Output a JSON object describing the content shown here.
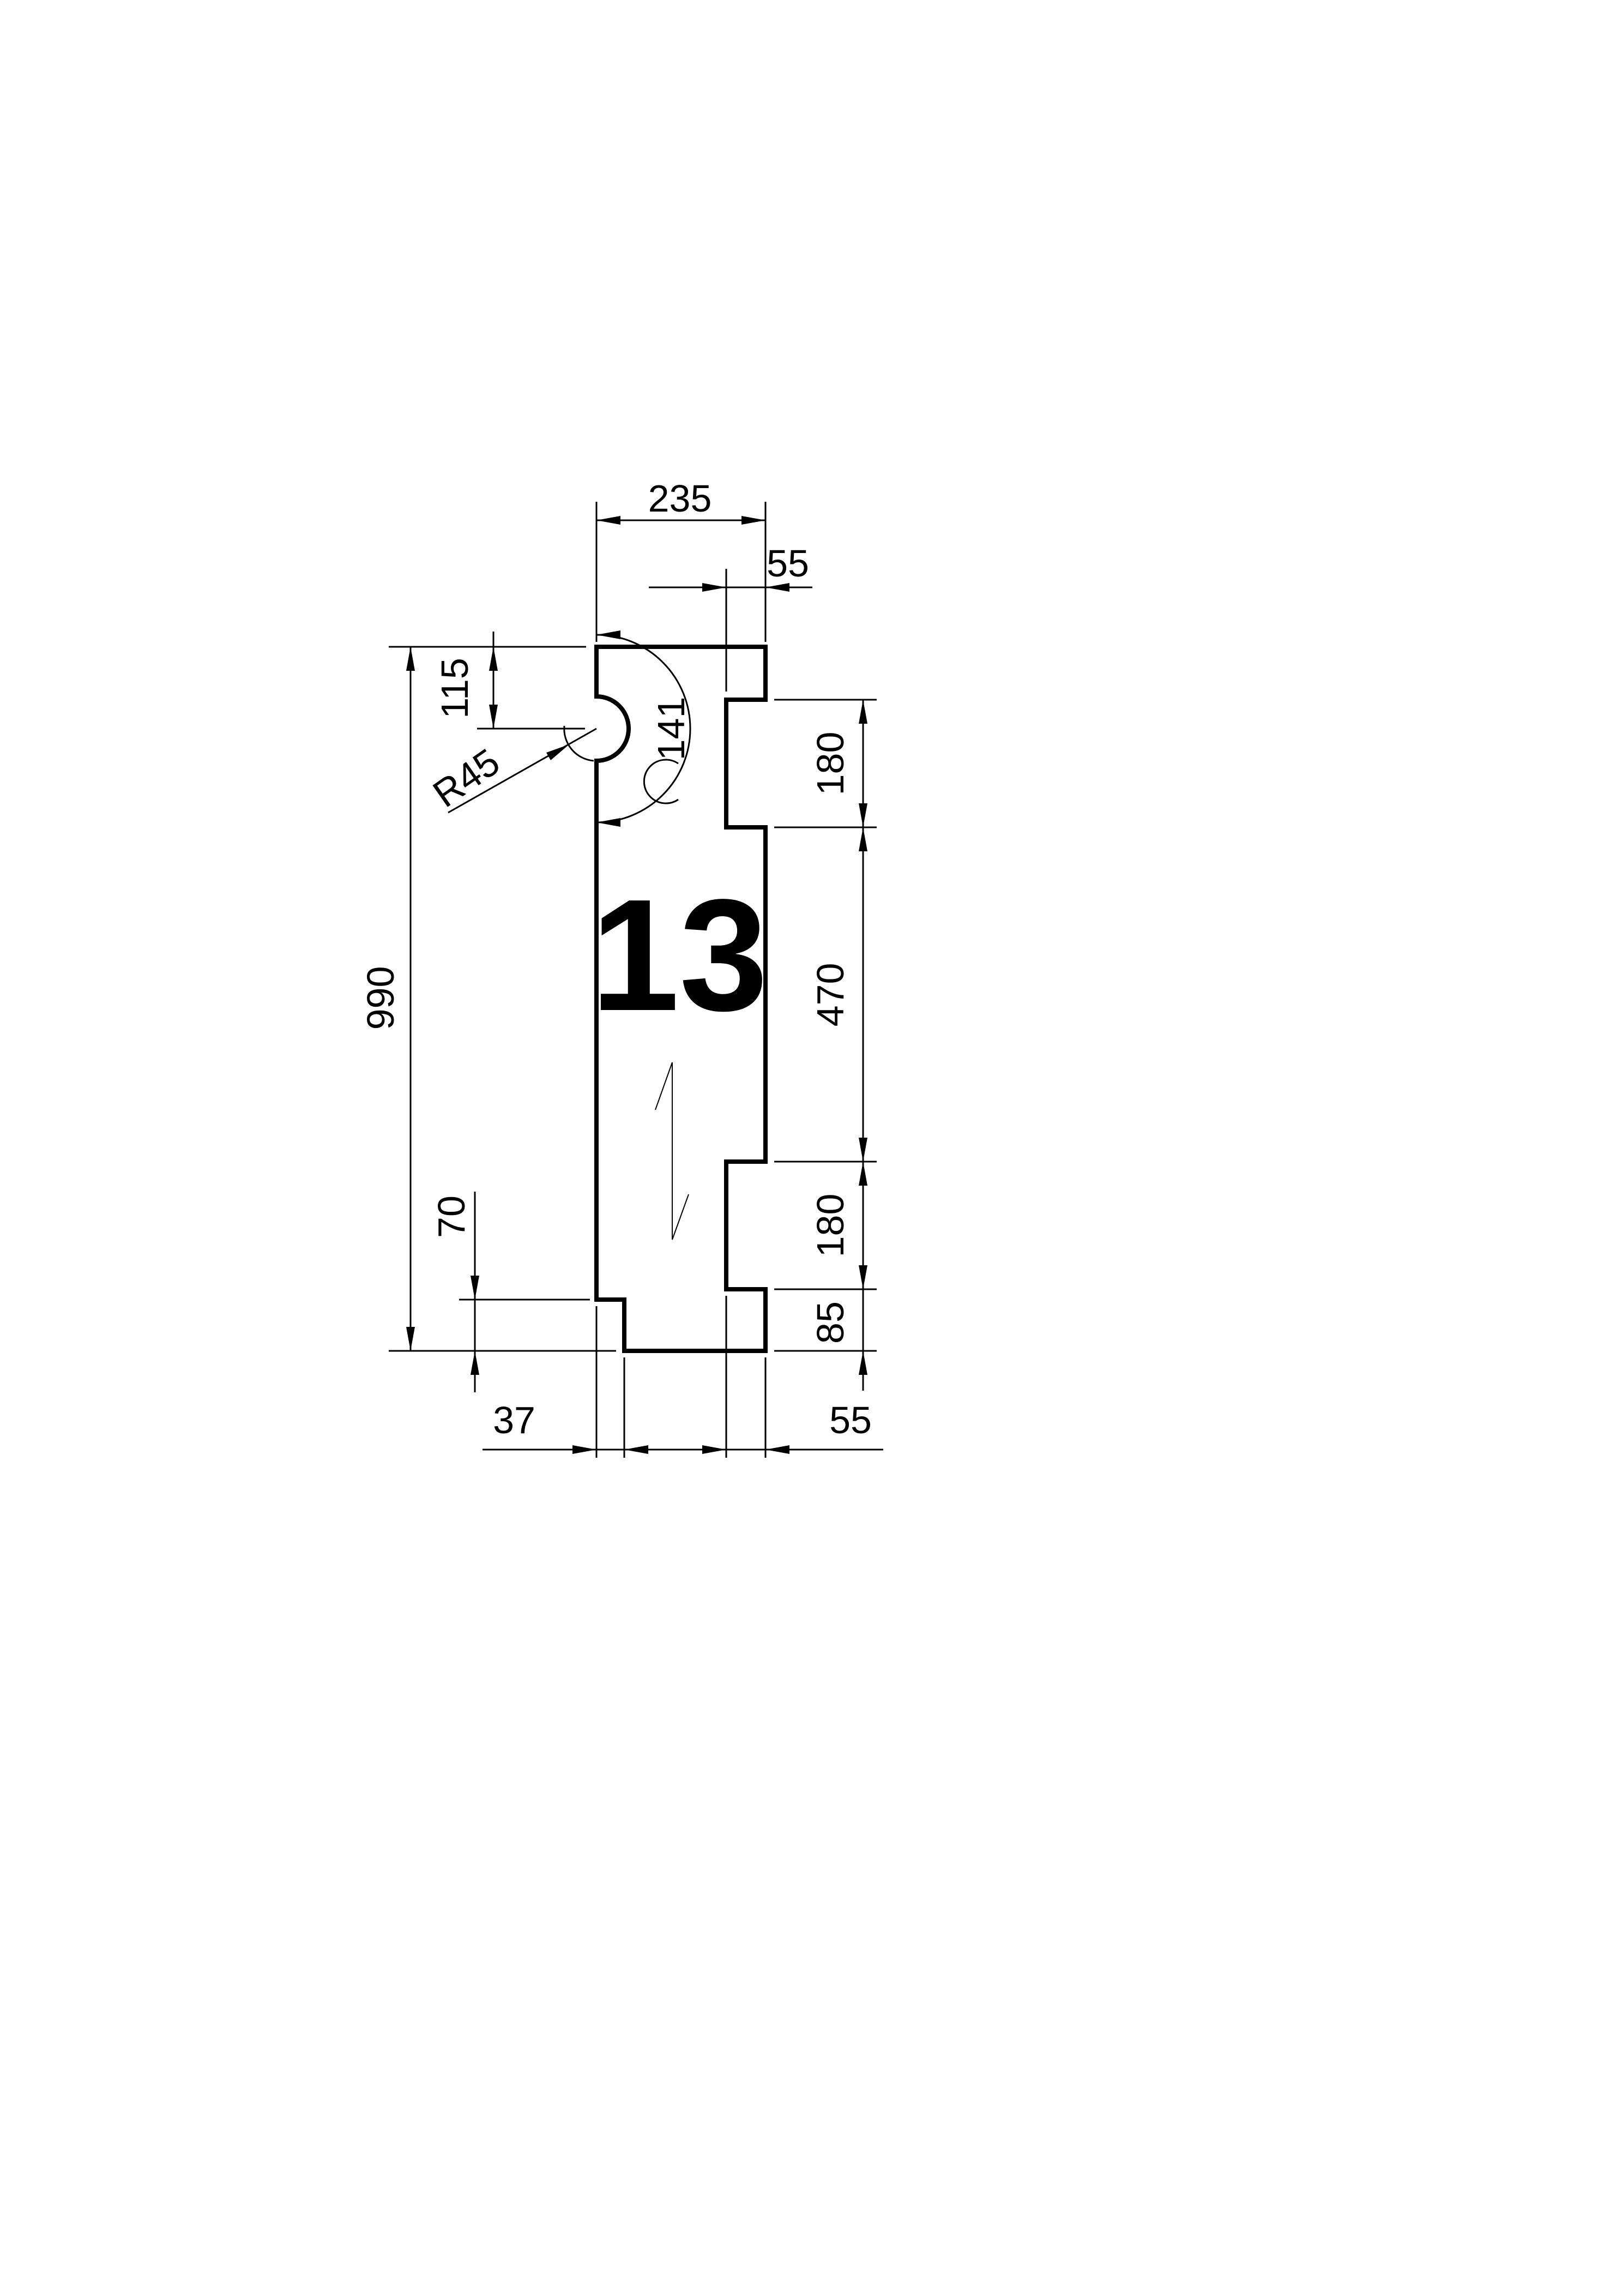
{
  "drawing": {
    "part_number": "13",
    "dimensions": {
      "width_top": "235",
      "notch_depth_top": "55",
      "semicircle_center_from_top": "115",
      "radius": "R45",
      "arc_length": "141",
      "total_height": "990",
      "notch1_height": "180",
      "middle_height": "470",
      "notch2_height": "180",
      "bottom_right_height": "85",
      "bottom_left_height": "70",
      "bottom_step_width": "37",
      "notch_depth_bottom": "55"
    },
    "colors": {
      "line": "#000000",
      "background": "#ffffff"
    }
  }
}
